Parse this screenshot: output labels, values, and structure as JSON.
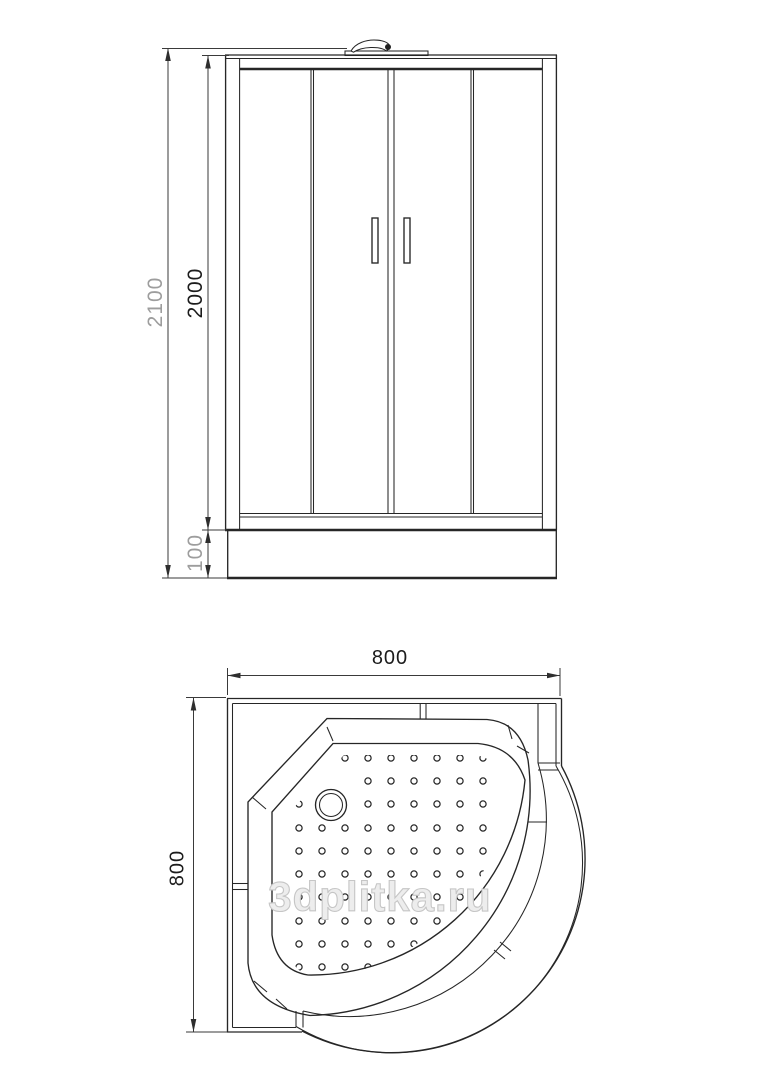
{
  "drawing_title": "shower-cabin-technical-drawing",
  "colors": {
    "background": "#ffffff",
    "line": "#262626",
    "dim_text_dark": "#1c1c1c",
    "dim_text_gray": "#9d9d9d",
    "watermark_gray": "#c6c6c6"
  },
  "elevation": {
    "view": "front-elevation",
    "dim_total_height": "2100",
    "dim_cabin_height": "2000",
    "dim_tray_height": "100"
  },
  "plan": {
    "view": "top-view",
    "dim_width": "800",
    "dim_depth": "800"
  },
  "watermark": "3dplitka.ru"
}
